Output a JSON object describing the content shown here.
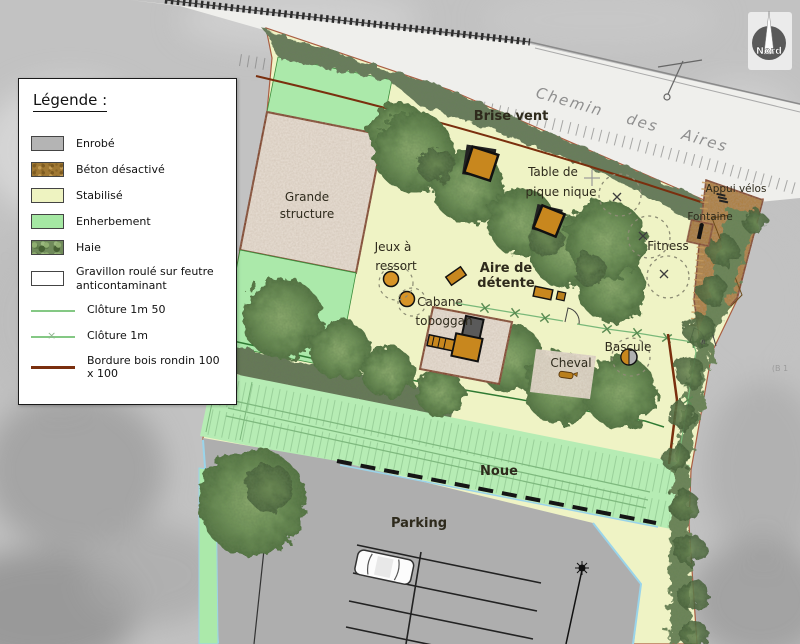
{
  "legend": {
    "title": "Légende :",
    "items": [
      {
        "id": "enrobe",
        "label": "Enrobé",
        "swatch": "enrobe",
        "color": "#b4b4b4"
      },
      {
        "id": "beton-desactive",
        "label": "Béton désactivé",
        "swatch": "beton",
        "color": "#a07833"
      },
      {
        "id": "stabilise",
        "label": "Stabilisé",
        "swatch": "stabilise",
        "color": "#eef3c1"
      },
      {
        "id": "enherbement",
        "label": "Enherbement",
        "swatch": "enherbement",
        "color": "#a5e8a3"
      },
      {
        "id": "haie",
        "label": "Haie",
        "swatch": "haie",
        "color": "#6f8a5a"
      },
      {
        "id": "gravillon",
        "label": "Gravillon roulé sur feutre anticontaminant",
        "swatch": "gravillon",
        "color": "#ffffff"
      },
      {
        "id": "cloture-1m50",
        "label": "Clôture 1m 50",
        "swatch": "line-green",
        "color": "#84c884"
      },
      {
        "id": "cloture-1m",
        "label": "Clôture 1m",
        "swatch": "line-green-x",
        "color": "#84c884"
      },
      {
        "id": "bordure-bois",
        "label": "Bordure bois rondin 100 x 100",
        "swatch": "line-brown",
        "color": "#7a2f0e"
      }
    ]
  },
  "compass": {
    "label": "Nord"
  },
  "road": {
    "name": "Chemin des Aires"
  },
  "labels": {
    "brise_vent": "Brise vent",
    "grande_structure_l1": "Grande",
    "grande_structure_l2": "structure",
    "table_l1": "Table de",
    "table_l2": "pique nique",
    "jeux_l1": "Jeux à",
    "jeux_l2": "ressort",
    "aire_l1": "Aire de",
    "aire_l2": "détente",
    "cabane_l1": "Cabane",
    "cabane_l2": "toboggan",
    "fitness": "Fitness",
    "cheval": "Cheval",
    "bascule": "Bascule",
    "noue": "Noue",
    "parking": "Parking",
    "appui_velos": "Appui vélos",
    "fontaine": "Fontaine",
    "parcel_ref": "(B 1"
  },
  "colors": {
    "background": "#c2c2c2",
    "stabilise": "#eff3c5",
    "enherbement": "#abe9aa",
    "enrobe_parking": "#aeaeae",
    "beton_desactive": "#ac7d37",
    "gravillon": "#e9e0d6",
    "bordure_bois": "#7a2f0e",
    "cloture": "#79b879",
    "cloture_1m50": "#2f7a33",
    "curb_blue": "#9ad4ea",
    "equipment_orange": "#c8871e",
    "road": "#efefec"
  }
}
